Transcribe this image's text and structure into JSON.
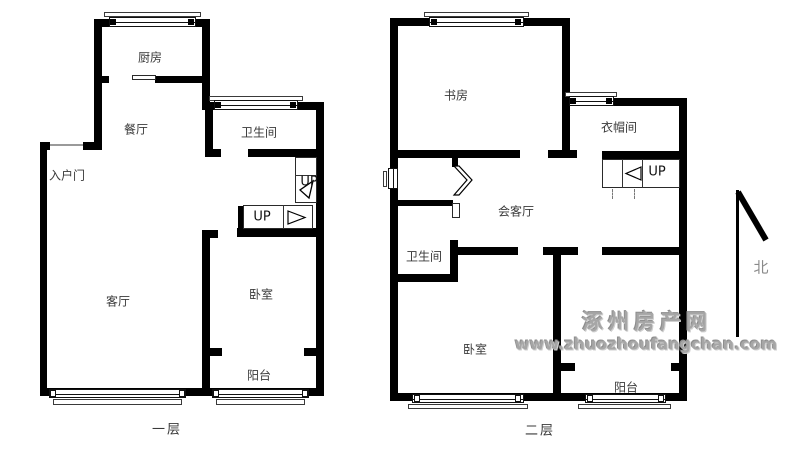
{
  "floors": {
    "first": {
      "caption": "一层",
      "rooms": {
        "kitchen": "厨房",
        "dining": "餐厅",
        "bathroom": "卫生间",
        "entry": "入户门",
        "living": "客厅",
        "bedroom": "卧室",
        "balcony": "阳台"
      },
      "stairs": {
        "upper_label": "UP",
        "lower_label": "UP"
      }
    },
    "second": {
      "caption": "二层",
      "rooms": {
        "study": "书房",
        "cloakroom": "衣帽间",
        "reception": "会客厅",
        "bathroom": "卫生间",
        "bedroom": "卧室",
        "balcony": "阳台"
      },
      "stairs": {
        "label": "UP"
      }
    }
  },
  "compass": {
    "north_label": "北"
  },
  "watermark": {
    "site_name": "涿州房产网",
    "site_url": "www.zhuozhoufangchan.com"
  },
  "colors": {
    "wall": "#000000",
    "room_label": "#3a3a3a",
    "watermark_gray": "#a6a6a6"
  }
}
